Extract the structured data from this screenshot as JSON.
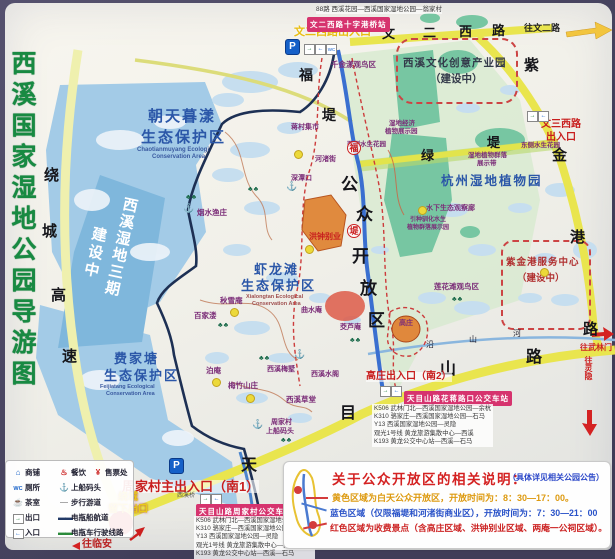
{
  "title": "西溪国家湿地公园导游图",
  "roads": {
    "ring_chars": [
      "绕",
      "城",
      "高",
      "速"
    ],
    "wenerxi_chars": [
      "文",
      "二",
      "西",
      "路"
    ],
    "zijingang_chars": [
      "紫",
      "金",
      "港",
      "路"
    ],
    "tianmushan_chars": [
      "天",
      "目",
      "山",
      "路"
    ],
    "ludi_chars": [
      "绿",
      "堤"
    ],
    "fudi_chars": [
      "福",
      "堤"
    ],
    "fudi_badge_chars": [
      "福",
      "堤"
    ],
    "yanshanhe_chars": [
      "沿",
      "山",
      "河"
    ],
    "to_wener": "往文二路",
    "to_wulinmen": "往武林门",
    "to_lingyin": "往灵隐",
    "to_linan": "往临安"
  },
  "open_area_chars": [
    "公",
    "众",
    "开",
    "放",
    "区"
  ],
  "entrances": {
    "wenerxi": "文二西路出入口",
    "wensanxi_l1": "文三西路",
    "wensanxi_l2": "出入口",
    "gaozhuang": "高庄出入口（南2）",
    "zhoujiacun": "周家村主出入口（南1）",
    "liuxia_l1": "绕城",
    "liuxia_l2": "留下出口",
    "parking": "P"
  },
  "bus": {
    "top_route": "88路 西溪花园—西溪国家湿地公园—翁家村",
    "stop_top": "文二西路十字港桥站",
    "stop_huajiang": "天目山路花蒋路口公交车站",
    "stop_zhoujiacun": "天目山路周家村公交车站",
    "routes": [
      "K506 武林门北—西溪国家湿地公园—余杭",
      "K310 骆家庄—西溪国家湿地公园—石马",
      "Y13 西溪国家湿地公园—灵隐",
      "观光1号线 黄龙旅游集散中心—西溪",
      "K193 黄龙公交中心站—西溪—石马"
    ]
  },
  "zones": {
    "chaotian": {
      "l1": "朝天暮漾",
      "l2": "生态保护区",
      "en1": "Chaotianmuyang Ecologi",
      "en2": "Conservation Area"
    },
    "xialongtan": {
      "l1": "虾龙滩",
      "l2": "生态保护区",
      "en1": "Xialongtan Ecological",
      "en2": "Conservation Area"
    },
    "feijiatang": {
      "l1": "费家塘",
      "l2": "生态保护区",
      "en1": "Feijiatang Ecological",
      "en2": "Conservation Area"
    },
    "phase3_l1": "西溪湿地三期",
    "phase3_l2": "建设中",
    "creative_l1": "西溪文化创意产业园",
    "creative_l2": "（建设中）",
    "botanic": "杭州湿地植物园",
    "service_l1": "紫金港服务中心",
    "service_l2": "（建设中）"
  },
  "pois": {
    "qianjinyang": "千金漾观鸟区",
    "jingji_l1": "湿地经济",
    "jingji_l2": "植物展示园",
    "qunluo_l1": "湿地植物群落",
    "qunluo_l2": "展示带",
    "east_garden": "东侧水生花园",
    "west_garden": "西侧水生花园",
    "guanchalan": "水下生态观察廊",
    "yinzhong_l1": "引种驯化水生",
    "yinzhong_l2": "植物群落展示园",
    "lianhuatan": "莲花滩观鸟区",
    "jiangcun": "蒋村集市",
    "hezhujie": "河渚街",
    "shentankou": "深潭口",
    "hongzhong": "洪钟别业",
    "yanshui": "烟水渔庄",
    "qiuxue": "秋雪庵",
    "baijialou": "百家溇",
    "qushui": "曲水庵",
    "jiaolu": "茭芦庵",
    "boan": "泊庵",
    "meizhu": "梅竹山庄",
    "meishu": "西溪梅墅",
    "shuige": "西溪水阁",
    "caotang": "西溪草堂",
    "dock_l1": "周家村",
    "dock_l2": "上船码头",
    "xixiqiao": "西溪桥",
    "gaozhuang": "高庄"
  },
  "icons": {
    "anchor": "⚓",
    "cluster": "♣♣",
    "exit": "→",
    "entry": "←",
    "wc": "WC"
  },
  "notice": {
    "title": "关于公众开放区的相关说明：",
    "subtitle": "（具体详见相关公园公告）",
    "line_yellow": "黄色区域为白天公众开放区，开放时间为：8：30—17：00。",
    "line_blue": "蓝色区域（仅限福堤和河渚街商业区），开放时间为：7：30—21：00",
    "line_red": "红色区域为收费景点（含高庄区域、洪钟别业区域、两庵一公祠区域）。"
  },
  "legend": {
    "items_left": [
      {
        "glyph": "⌂",
        "label": "商铺"
      },
      {
        "glyph": "WC",
        "label": "厕所"
      },
      {
        "glyph": "☕",
        "label": "茶室"
      },
      {
        "glyph": "→",
        "label": "出口"
      },
      {
        "glyph": "←",
        "label": "入口"
      }
    ],
    "items_right": [
      {
        "glyph": "♨",
        "label": "餐饮"
      },
      {
        "glyph": "⚓",
        "label": "上船码头"
      },
      {
        "glyph": "—",
        "label": "步行游道"
      },
      {
        "glyph": "▬▬",
        "label": "电瓶船航道"
      },
      {
        "glyph": "▬▬",
        "label": "电瓶车行驶线路"
      }
    ],
    "ticket": {
      "glyph": "¥",
      "label": "售票处"
    }
  }
}
